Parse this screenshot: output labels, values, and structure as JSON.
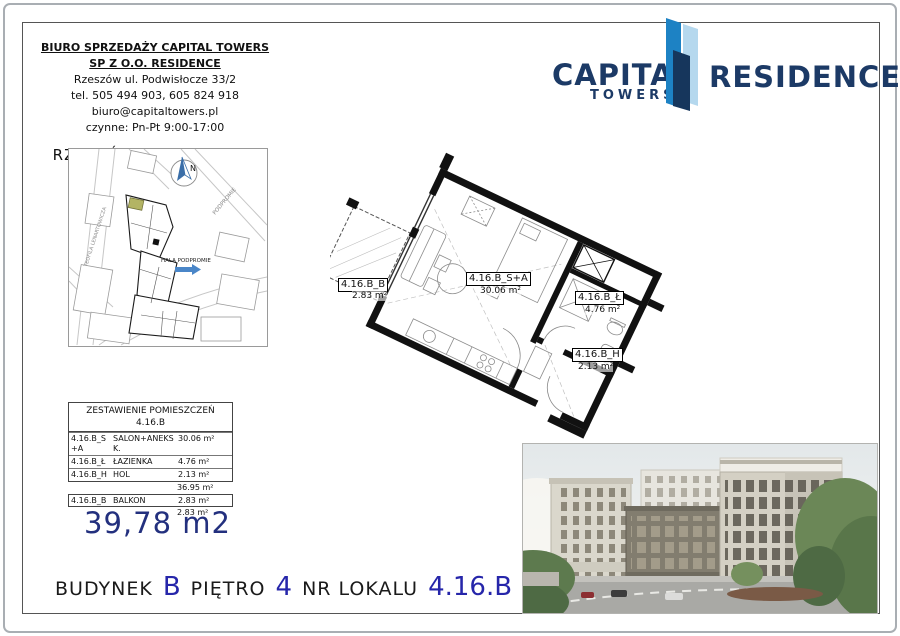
{
  "office": {
    "line1": "BIURO SPRZEDAŻY CAPITAL TOWERS",
    "line2": "SP Z O.O. RESIDENCE",
    "address": "Rzeszów ul. Podwisłocze 33/2",
    "phone": "tel. 505 494 903, 605 824 918",
    "email": "biuro@capitaltowers.pl",
    "hours": "czynne: Pn-Pt 9:00-17:00",
    "location": "RZESZÓW,  PODPROMIE"
  },
  "logo": {
    "brand_top": "CAPITAL",
    "brand_sub": "TOWERS",
    "brand_right": "RESIDENCE",
    "navy": "#1c3a66",
    "tower_blue": "#1d82c4",
    "tower_light": "#b5d8ee",
    "tower_dark": "#16365c"
  },
  "map": {
    "street_left": "TEOFILA LENARTOWICZA",
    "street_right": "PODPROMIE",
    "hall_label": "HALA PODPROMIE",
    "compass_letter": "N",
    "highlight_color": "#b3b464",
    "arrow_color": "#4a86c8"
  },
  "floorplan": {
    "rooms": [
      {
        "code": "4.16.B_B",
        "area": "2.83 m²"
      },
      {
        "code": "4.16.B_S+A",
        "area": "30.06 m²"
      },
      {
        "code": "4.16.B_Ł",
        "area": "4.76 m²"
      },
      {
        "code": "4.16.B_H",
        "area": "2.13 m²"
      }
    ]
  },
  "table": {
    "title": "ZESTAWIENIE POMIESZCZEŃ",
    "subtitle": "4.16.B",
    "rows": [
      {
        "code": "4.16.B_S+A",
        "name": "SALON+ANEKS K.",
        "area": "30.06 m²"
      },
      {
        "code": "4.16.B_Ł",
        "name": "ŁAZIENKA",
        "area": "4.76 m²"
      },
      {
        "code": "4.16.B_H",
        "name": "HOL",
        "area": "2.13 m²"
      }
    ],
    "subtotal": "36.95 m²",
    "balcony_row": {
      "code": "4.16.B_B",
      "name": "BALKON",
      "area": "2.83 m²"
    },
    "balcony_total": "2.83 m²",
    "total": "39,78 m2"
  },
  "footer": {
    "building_label": "BUDYNEK",
    "building_value": "B",
    "floor_label": "PIĘTRO",
    "floor_value": "4",
    "unit_label": "NR LOKALU",
    "unit_value": "4.16.B"
  }
}
